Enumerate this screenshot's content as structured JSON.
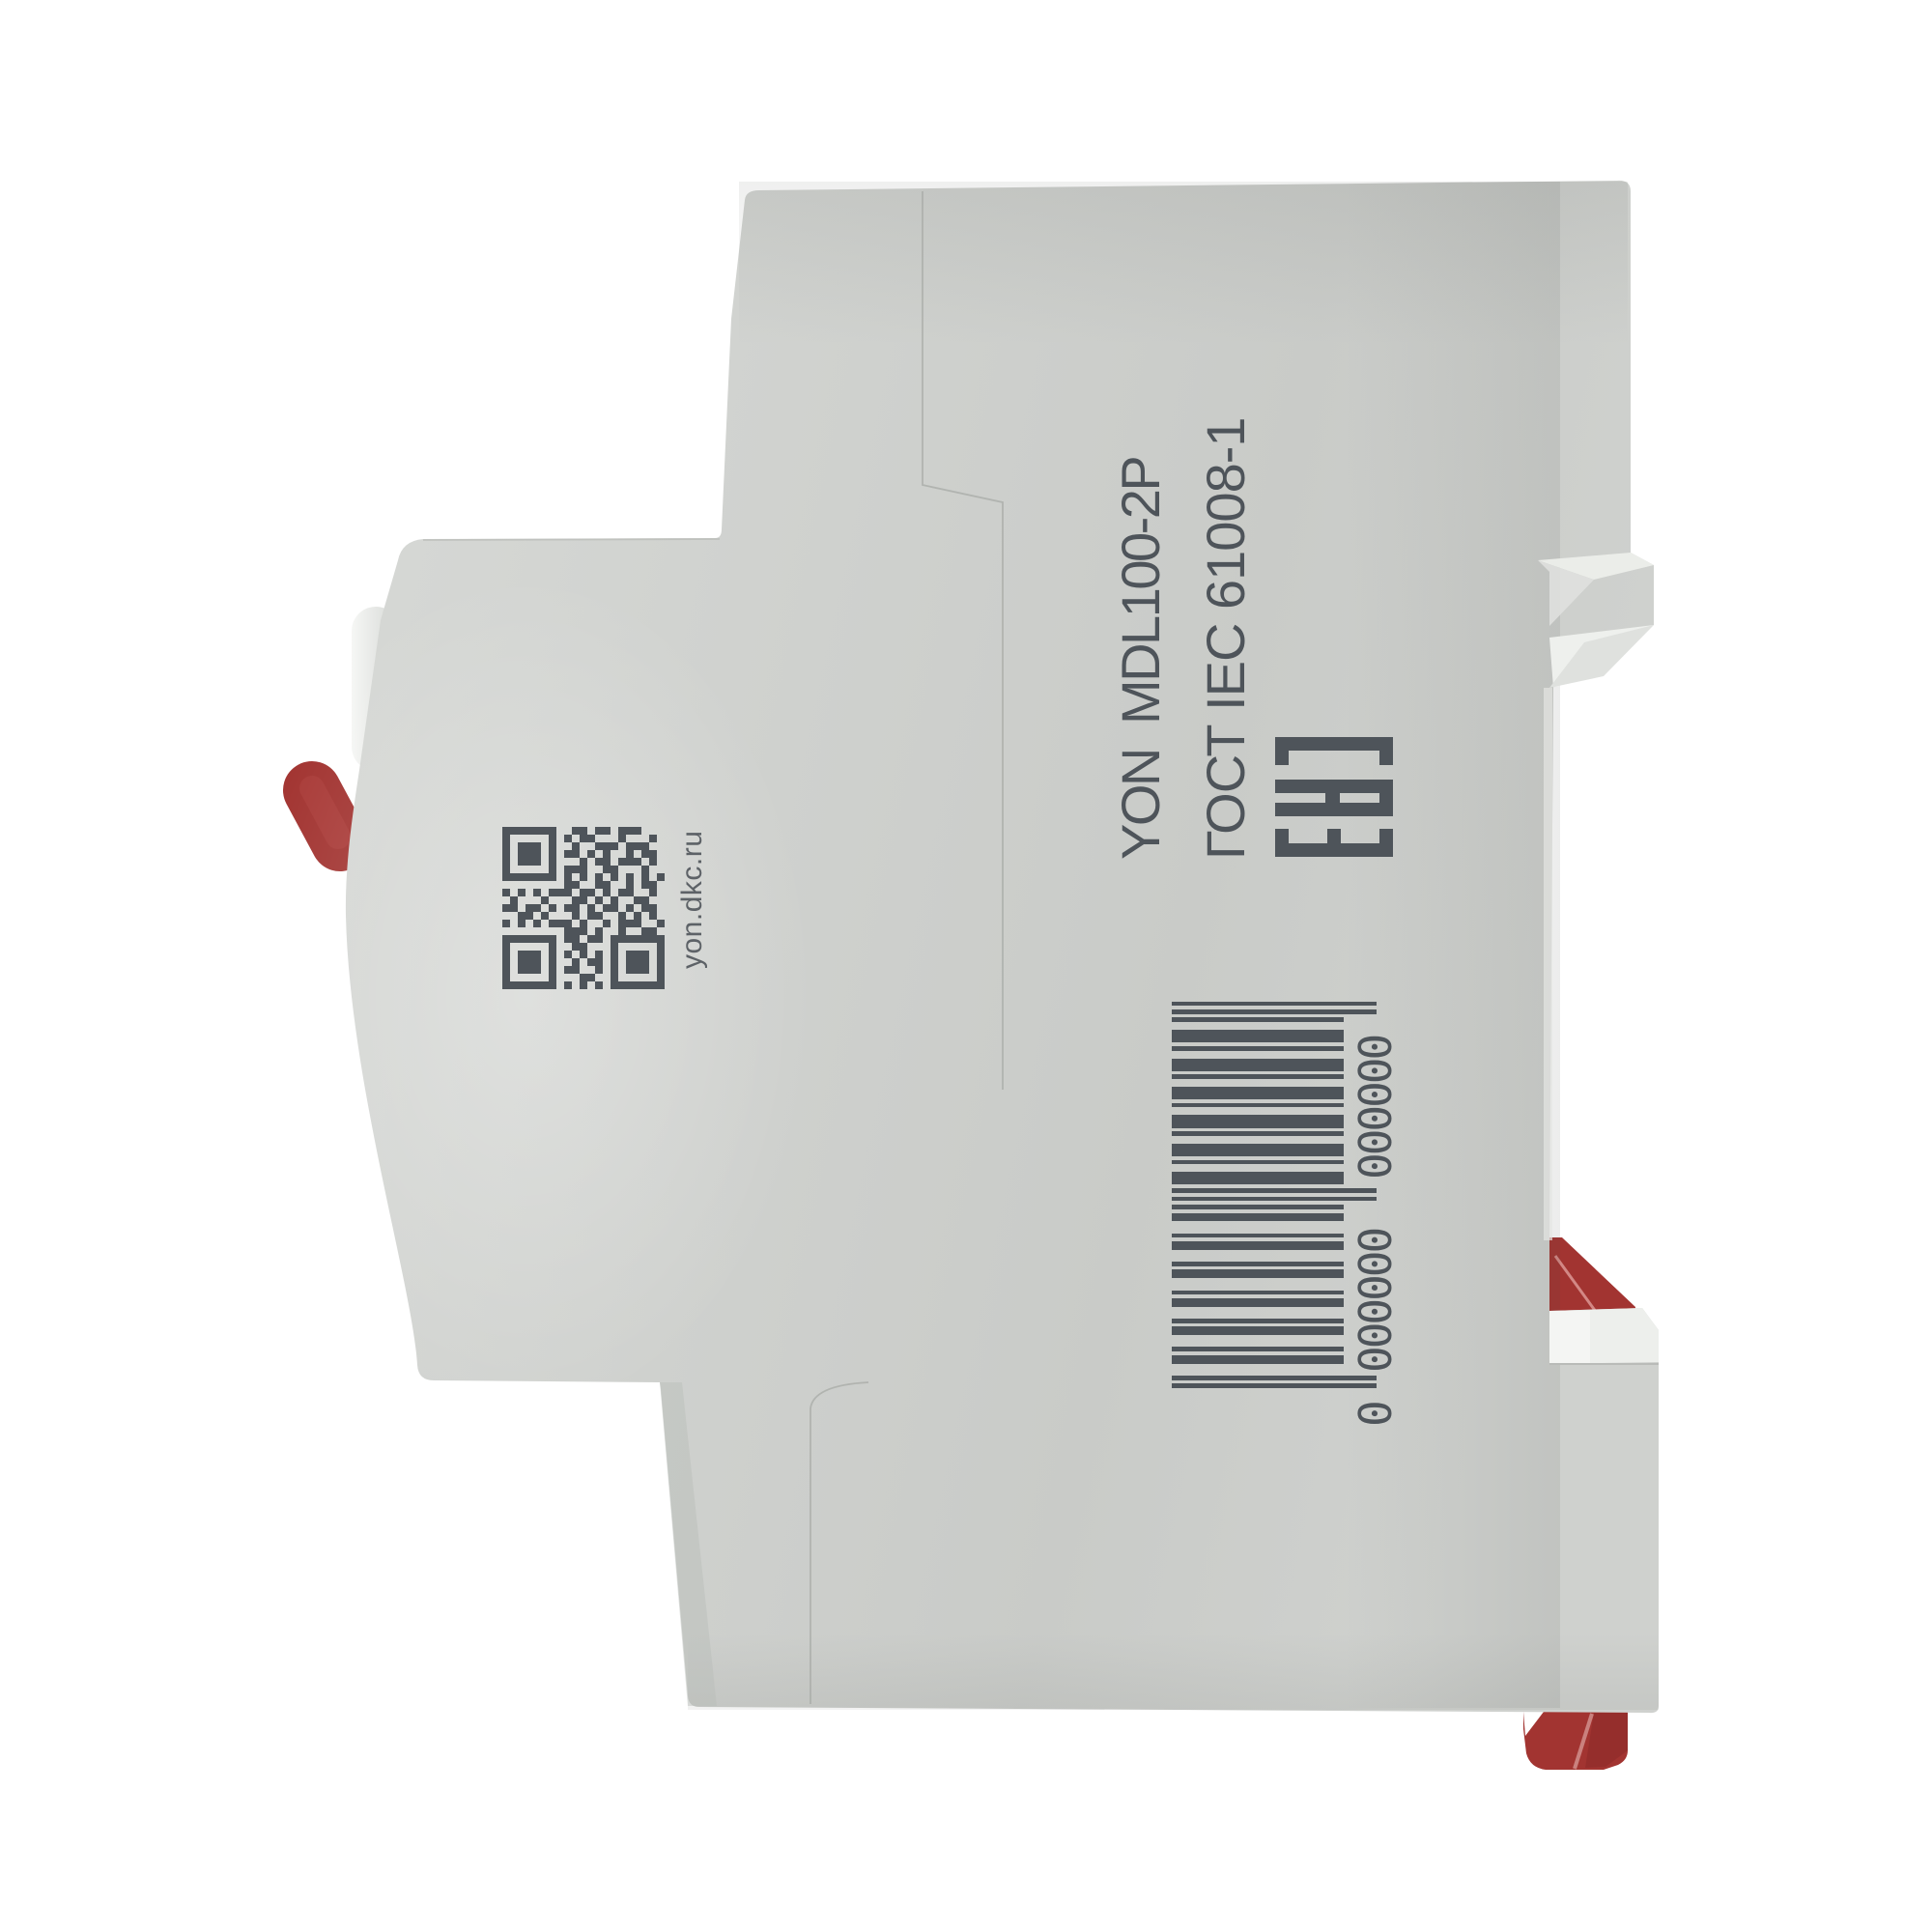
{
  "product": {
    "model_label": "YON  MDL100-2P",
    "standard_label": "ГОСТ IEC 61008-1",
    "cert_mark": "EAC",
    "qr_caption": "yon.dkc.ru"
  },
  "barcode": {
    "human_readable": "0 000000 000000",
    "text_lead": "0",
    "text_group1": "000000",
    "text_group2": "000000",
    "modules": "1010001101000110100011010001101000110100011010101011100101110010111001011100101110010111001 0101",
    "module_string": "101000110100011010001101000110100011010001101010101110010111001011100101110010111001011100 10101",
    "ean": "101",
    "left_block": "000110100011010001101000110100011010001101",
    "middle_guard": "01010",
    "right_block": "111001011100101110010111001011100101110010",
    "end_guard": "101",
    "guard_indices": [
      0,
      1,
      2,
      45,
      46,
      47,
      48,
      49,
      92,
      93,
      94
    ]
  },
  "qr": {
    "rows": [
      "111111100110110111000",
      "100000101011000100010",
      "101110100100111011100",
      "101110101101010010110",
      "101110100010110111010",
      "100000101110011000100",
      "111111101010101010101",
      "000000001100110010110",
      "101010111011010110010",
      "010001000110101001100",
      "110110101101011010110",
      "001101000101100101010",
      "101010111010010111001",
      "000000001110100100110",
      "111111101101101111111",
      "100000100110001000001",
      "101110101010101011101",
      "101110100101101011101",
      "101110101100101011101",
      "100000100011001000001",
      "111111101010101111111"
    ]
  },
  "colors": {
    "background": "#ffffff",
    "body_gray": "#cdcfcc",
    "panel_highlight": "#d7d9d6",
    "print_dark": "#4e545a",
    "red_accent": "#a23431",
    "white_plastic": "#eef0ed"
  }
}
